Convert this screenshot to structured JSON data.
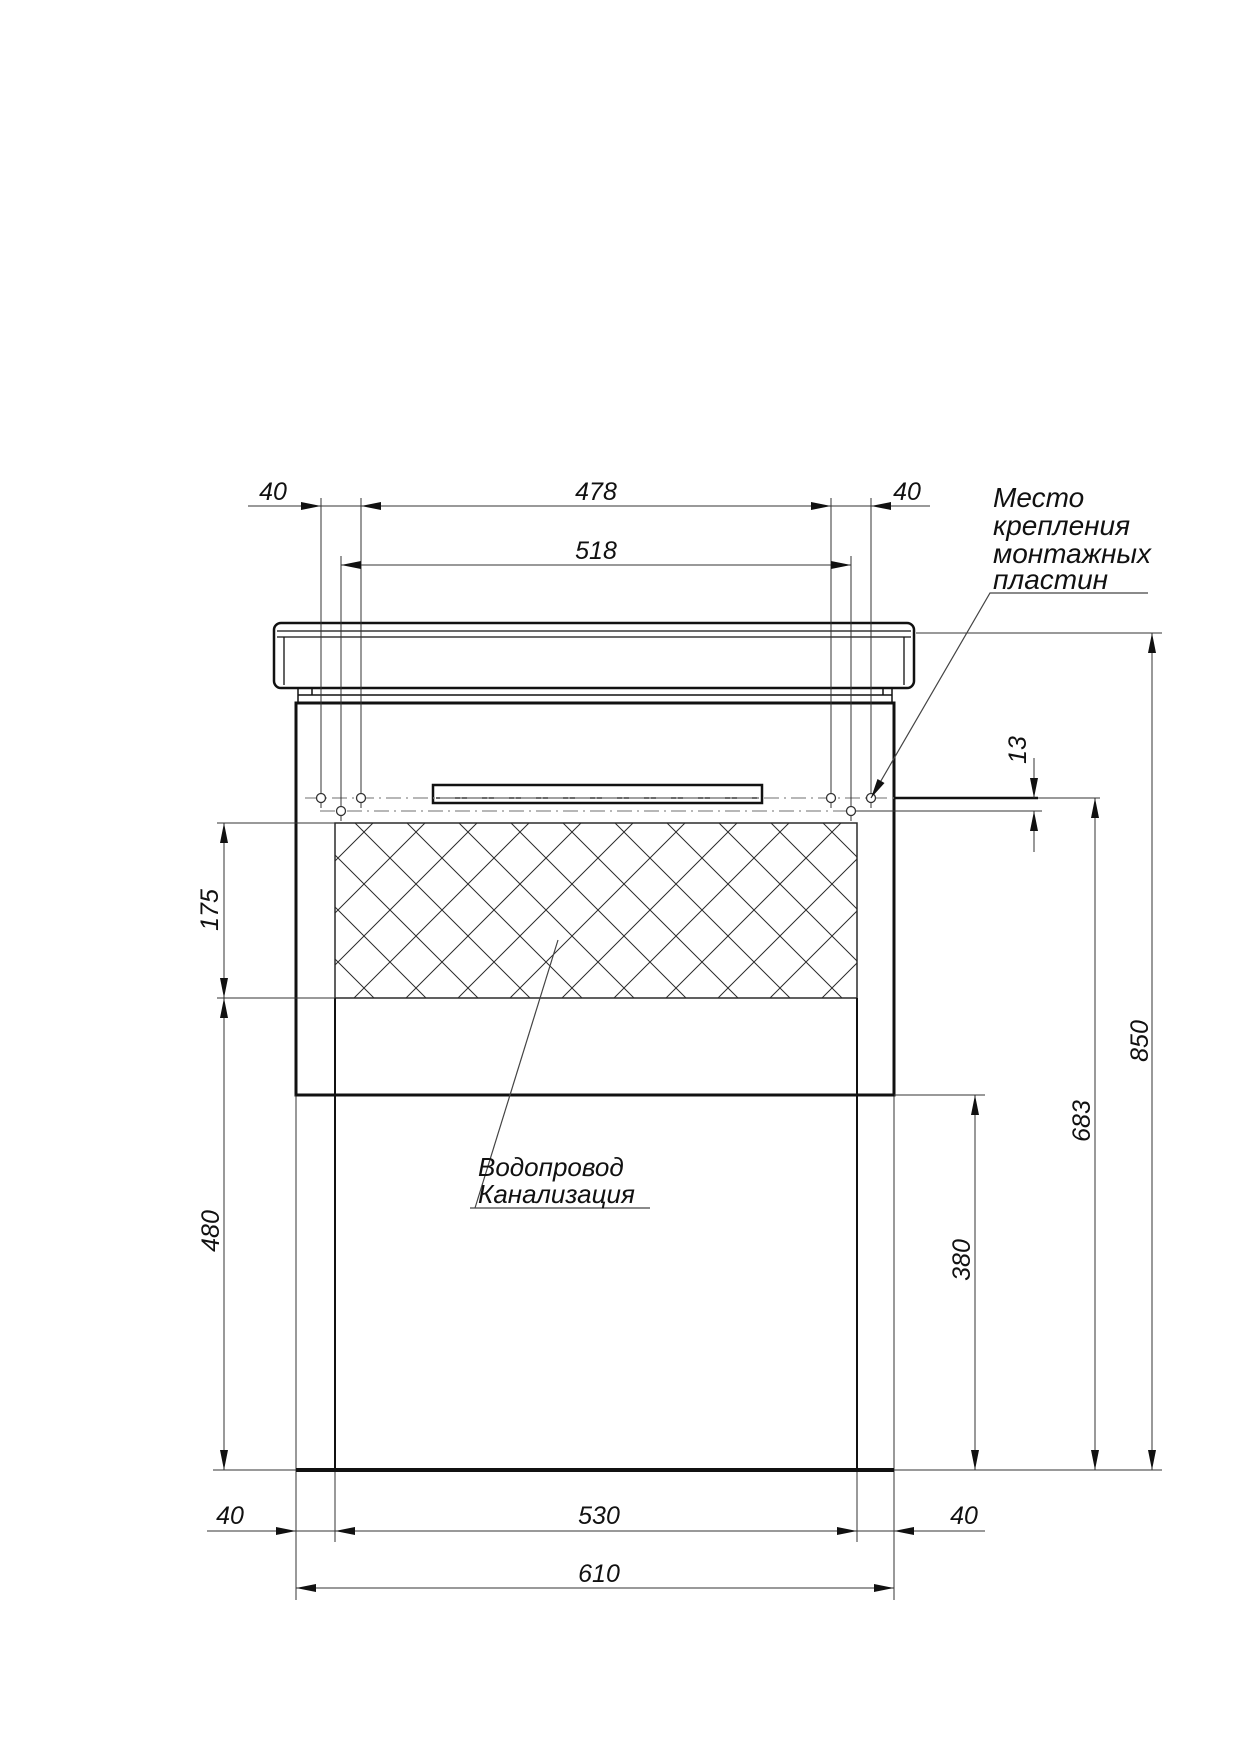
{
  "drawing": {
    "kind": "furniture-installation-drawing",
    "callout_mounting": [
      "Место",
      "крепления",
      "монтажных",
      "пластин"
    ],
    "callout_plumbing": [
      "Водопровод",
      "Канализация"
    ],
    "dims": {
      "top_left_40": "40",
      "span_478": "478",
      "span_518": "518",
      "top_right_40": "40",
      "gap_13": "13",
      "hatch_175": "175",
      "left_480": "480",
      "plates_683": "683",
      "lower_380": "380",
      "total_850": "850",
      "bottom_left_40": "40",
      "span_530": "530",
      "bottom_right_40": "40",
      "total_610": "610"
    },
    "colors": {
      "line": "#111111",
      "dimension": "#333333",
      "centerline": "#8c8c8c",
      "background": "#ffffff"
    }
  }
}
